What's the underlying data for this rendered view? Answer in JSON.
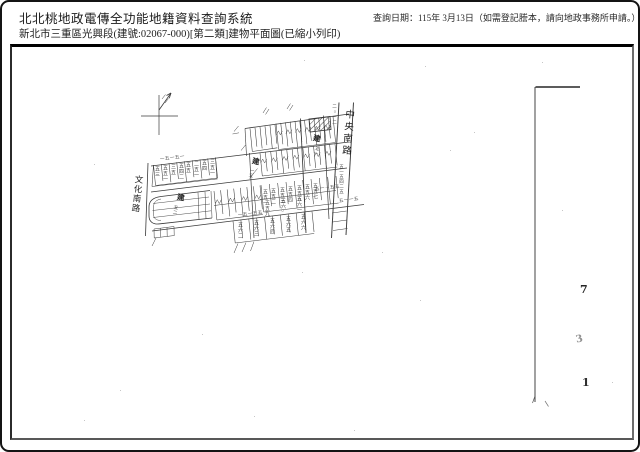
{
  "header": {
    "system_title": "北北桃地政電傳全功能地籍資料查詢系統",
    "document_title": "新北市三重區光興段(建號:02067-000)[第二類]建物平面圖(已縮小列印)",
    "query_note": "查詢日期：115年 3月13日（如需登記謄本，請向地政事務所申請。）"
  },
  "map": {
    "road_left": "文化南路",
    "road_right": "中央南路",
    "building_marks": [
      "建",
      "建",
      "建"
    ],
    "road_small_top": "二○一二",
    "road_small_bottom": "五一五四二五",
    "range_label": "五一－五五",
    "edge_labels": [
      "一五一五一",
      "一五一五五",
      "五一一五"
    ],
    "lot_labels": [
      "五三",
      "五五一",
      "三五",
      "五四二",
      "五五",
      "二五一",
      "五四",
      "三五一",
      "五五一",
      "五五二",
      "五五三",
      "五五四",
      "五五五",
      "五五六",
      "五五七",
      "五五九",
      "五六○",
      "五六一",
      "五六二",
      "五六三",
      "五六四",
      "五六五",
      "五六六",
      "五一",
      "一五",
      "五二"
    ],
    "margin_numbers": [
      "7",
      "3",
      "1"
    ]
  }
}
